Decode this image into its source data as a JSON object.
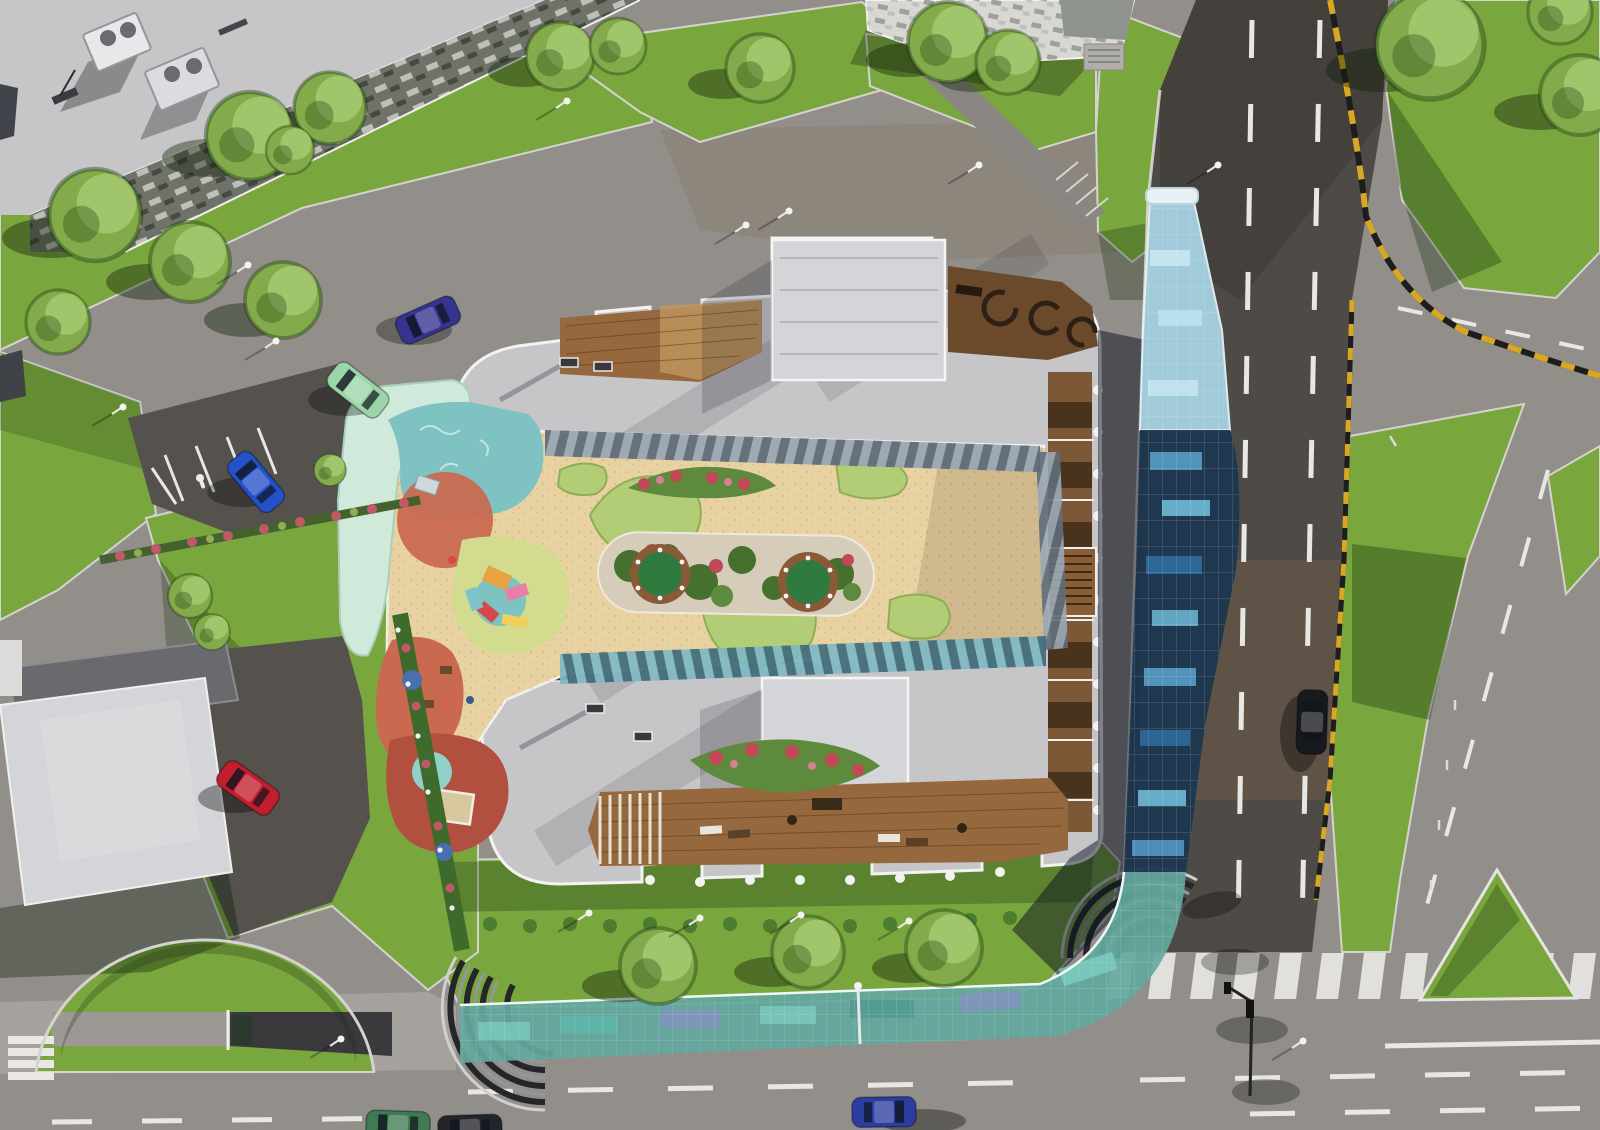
{
  "meta": {
    "type": "aerial-architectural-render",
    "subject": "top-down render of a residential complex with inner courtyard playground, glass walkway canopy, surrounding streets, lawns and parked cars",
    "camera": "top-down"
  },
  "palette": {
    "asphalt": "#928f8a",
    "asphalt_dark": "#55524d",
    "road_dark": "#4e4a45",
    "road_brown": "#6d5a48",
    "sidewalk": "#a5a29d",
    "marking": "#e9e7e3",
    "curb_yellow": "#d8a825",
    "grass": "#7aa63e",
    "grass_dark": "#55842c",
    "tree": "#83ab4b",
    "hedge": "#44622e",
    "flower_red": "#c04858",
    "roof_light": "#c6c6c9",
    "roof_block": "#d4d5d8",
    "parapet": "#f2f2f0",
    "facade_a": "#6e7268",
    "facade_b": "#d8d7d2",
    "wood": "#96683e",
    "wood_dark": "#6b4a2c",
    "tan": "#e9d2a2",
    "bed_gray": "#d5ccba",
    "garden_green": "#b2cd76",
    "shrub": "#47702f",
    "planter": "#8a5a38",
    "planter_green": "#2f7a3f",
    "mint": "#cfe9da",
    "teal": "#7fc2c2",
    "terracotta": "#c96a50",
    "yellow_green": "#d3dc8e",
    "red_brown": "#b2503f",
    "canopy_top": "#a9d5e6",
    "canopy_mid": "#1c3750",
    "canopy_bottom": "#63a89d",
    "white": "#f5f5f3"
  },
  "scene": {
    "buildings": [
      {
        "name": "main-residential-block",
        "features": [
          "inner-courtyard",
          "children-playground",
          "roof-terraces",
          "wooden-decks",
          "raised-roof-blocks",
          "scalloped-balconies"
        ]
      },
      {
        "name": "neighbor-building-top-left",
        "features": [
          "rooftop-hvac-units",
          "window-facade"
        ]
      },
      {
        "name": "neighbor-building-top-center",
        "features": [
          "window-facade",
          "stair-block"
        ]
      },
      {
        "name": "low-building-bottom-left",
        "features": [
          "service-yard"
        ]
      }
    ],
    "landscape": {
      "trees": 21,
      "lawns": 12,
      "flower_hedges": 3,
      "tree_row_bottom": 3
    },
    "roads": [
      {
        "name": "top-diagonal-street",
        "markings": [
          "parking-bays",
          "disabled-parking-symbols"
        ]
      },
      {
        "name": "right-vertical-avenue",
        "markings": [
          "dashed-lane-lines",
          "zebra-crosswalk",
          "yellow-black-curb"
        ]
      },
      {
        "name": "bottom-street",
        "markings": [
          "dashed-lane-lines",
          "solid-line",
          "zebra-crosswalk"
        ]
      },
      {
        "name": "right-slip-road",
        "markings": [
          "dashed-center-line",
          "bollards"
        ]
      }
    ],
    "amenities": [
      {
        "name": "glass-walkway-canopy",
        "segments": [
          "light-blue-top",
          "dark-blue-middle",
          "iridescent-teal-bottom"
        ]
      },
      {
        "name": "playground",
        "zones": [
          "mint",
          "teal",
          "terracotta",
          "yellow_green",
          "red_brown"
        ]
      },
      {
        "name": "central-garden-bed",
        "planters": 2
      },
      {
        "name": "ribbed-arc-pavilion",
        "count": 2
      },
      {
        "name": "underground-parking-ramp"
      },
      {
        "name": "semicircular-lawn-mound"
      },
      {
        "name": "traffic-light"
      },
      {
        "name": "street-lamps",
        "count": 14
      }
    ]
  },
  "cars": [
    {
      "name": "hatchback-mint",
      "hex": "#9cd6a8"
    },
    {
      "name": "sedan-indigo",
      "hex": "#35348e"
    },
    {
      "name": "sedan-blue-parked",
      "hex": "#2450c8"
    },
    {
      "name": "sedan-red-parked",
      "hex": "#c11f2e"
    },
    {
      "name": "sedan-black",
      "hex": "#17191e"
    },
    {
      "name": "sedan-royal-blue",
      "hex": "#2b3da0"
    },
    {
      "name": "car-edge-green",
      "hex": "#3f7a52"
    },
    {
      "name": "car-edge-dark",
      "hex": "#23252b"
    }
  ]
}
